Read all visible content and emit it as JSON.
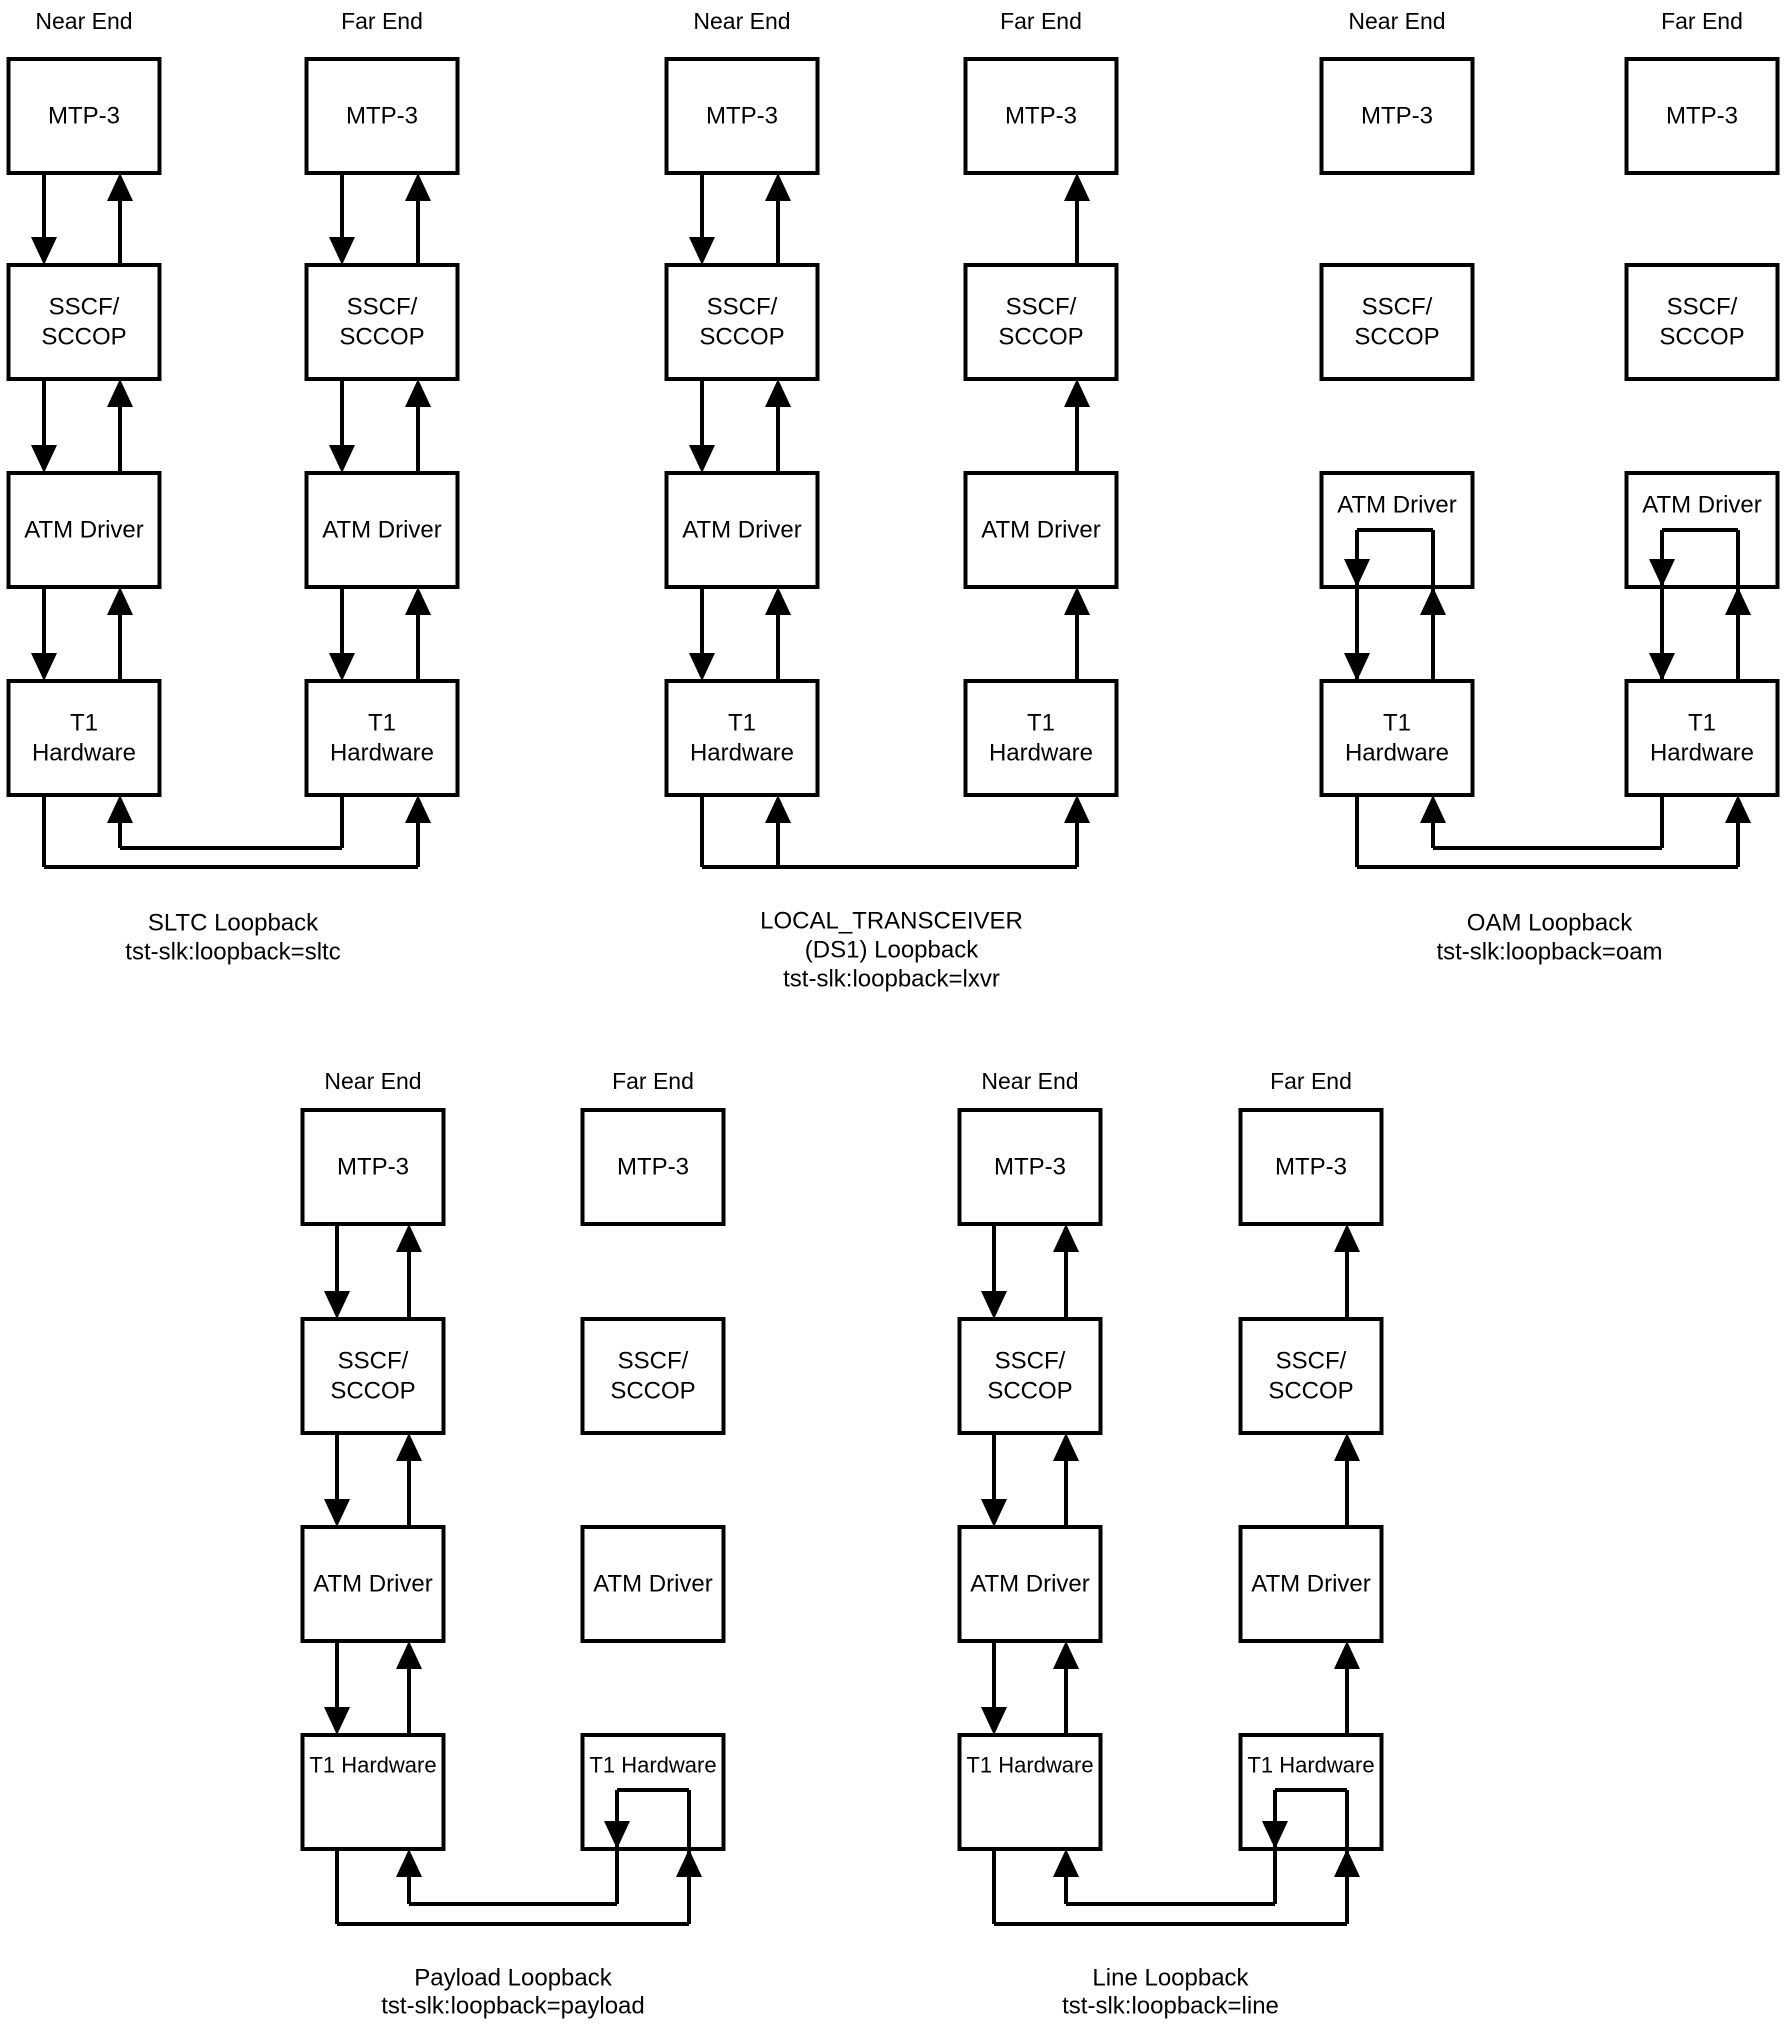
{
  "figure": {
    "background": "#ffffff",
    "ink": "#000000",
    "column_labels": {
      "near": "Near End",
      "far": "Far End"
    },
    "box_labels": {
      "mtp3": "MTP-3",
      "sscf": [
        "SSCF/",
        "SCCOP"
      ],
      "atm": "ATM Driver",
      "t1_stacked": [
        "T1",
        "Hardware"
      ],
      "t1_inline": "T1 Hardware"
    },
    "diagrams": [
      {
        "id": "sltc",
        "row": "top",
        "near_center": 84,
        "far_center": 382,
        "near_pattern": "duplex",
        "far_pattern": "duplex",
        "bottom_pattern": "crossed-loop",
        "t1_label_style": "stacked",
        "caption_lines": [
          "SLTC Loopback",
          "tst-slk:loopback=sltc"
        ]
      },
      {
        "id": "local-transceiver",
        "row": "top",
        "near_center": 742,
        "far_center": 1041,
        "near_pattern": "duplex",
        "far_pattern": "receive-only",
        "bottom_pattern": "branch-loop",
        "t1_label_style": "stacked",
        "caption_lines": [
          "LOCAL_TRANSCEIVER",
          "(DS1) Loopback",
          "tst-slk:loopback=lxvr"
        ]
      },
      {
        "id": "oam",
        "row": "top",
        "near_center": 1397,
        "far_center": 1702,
        "near_pattern": "atm-internal-loop",
        "far_pattern": "atm-internal-loop",
        "bottom_pattern": "crossed-loop",
        "t1_label_style": "stacked",
        "caption_lines": [
          "OAM Loopback",
          "tst-slk:loopback=oam"
        ]
      },
      {
        "id": "payload",
        "row": "bottom",
        "near_center": 373,
        "far_center": 653,
        "near_pattern": "duplex",
        "far_pattern": "isolated",
        "bottom_pattern": "t1-internal-loop",
        "t1_label_style": "inline",
        "caption_lines": [
          "Payload Loopback",
          "tst-slk:loopback=payload"
        ]
      },
      {
        "id": "line",
        "row": "bottom",
        "near_center": 1030,
        "far_center": 1311,
        "near_pattern": "duplex",
        "far_pattern": "receive-only",
        "bottom_pattern": "t1-internal-loop",
        "t1_label_style": "inline",
        "caption_lines": [
          "Line Loopback",
          "tst-slk:loopback=line"
        ]
      }
    ]
  }
}
